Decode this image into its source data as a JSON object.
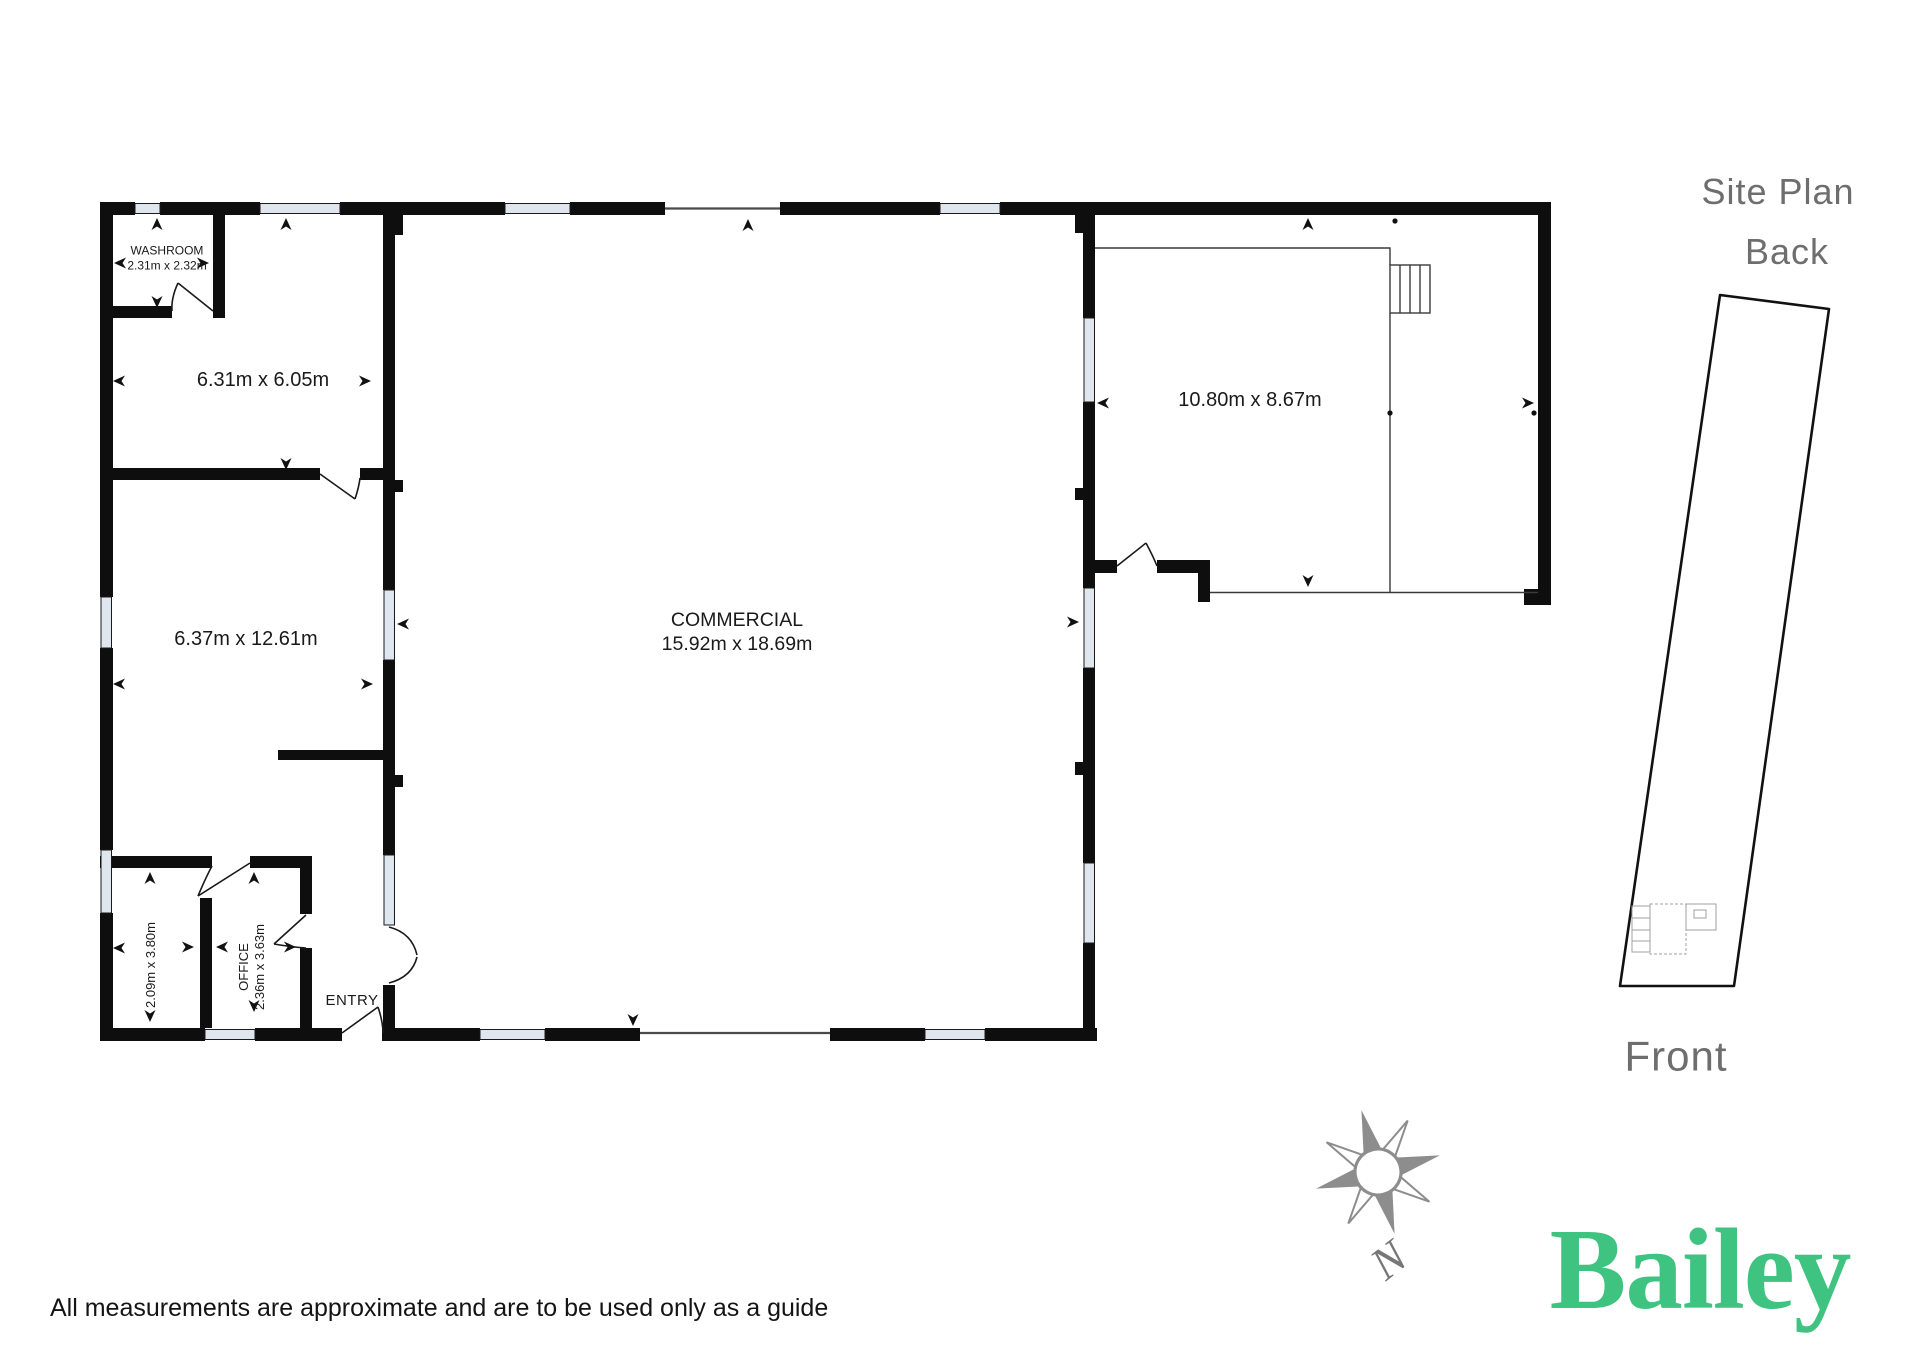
{
  "floor_plan": {
    "rooms": [
      {
        "name": "WASHROOM",
        "dims": "2.31m x 2.32m"
      },
      {
        "name": "",
        "dims": "6.31m x 6.05m"
      },
      {
        "name": "",
        "dims": "6.37m x 12.61m"
      },
      {
        "name": "",
        "dims": "2.09m x 3.80m"
      },
      {
        "name": "OFFICE",
        "dims": "2.36m x 3.63m"
      },
      {
        "name": "ENTRY",
        "dims": ""
      },
      {
        "name": "COMMERCIAL",
        "dims": "15.92m x 18.69m"
      },
      {
        "name": "",
        "dims": "10.80m x 8.67m"
      }
    ]
  },
  "site_plan": {
    "title": "Site Plan",
    "back_label": "Back",
    "front_label": "Front"
  },
  "compass": {
    "north_label": "N"
  },
  "branding": {
    "logo_text": "Bailey"
  },
  "footer": {
    "disclaimer": "All measurements are approximate and are to be used only as a guide"
  },
  "colors": {
    "wall": "#0e0e0e",
    "window_fill": "#dfe6ee",
    "site_plan_text": "#6e6e6e",
    "compass_gray": "#8d8d8d",
    "logo_green": "#3fc380"
  }
}
